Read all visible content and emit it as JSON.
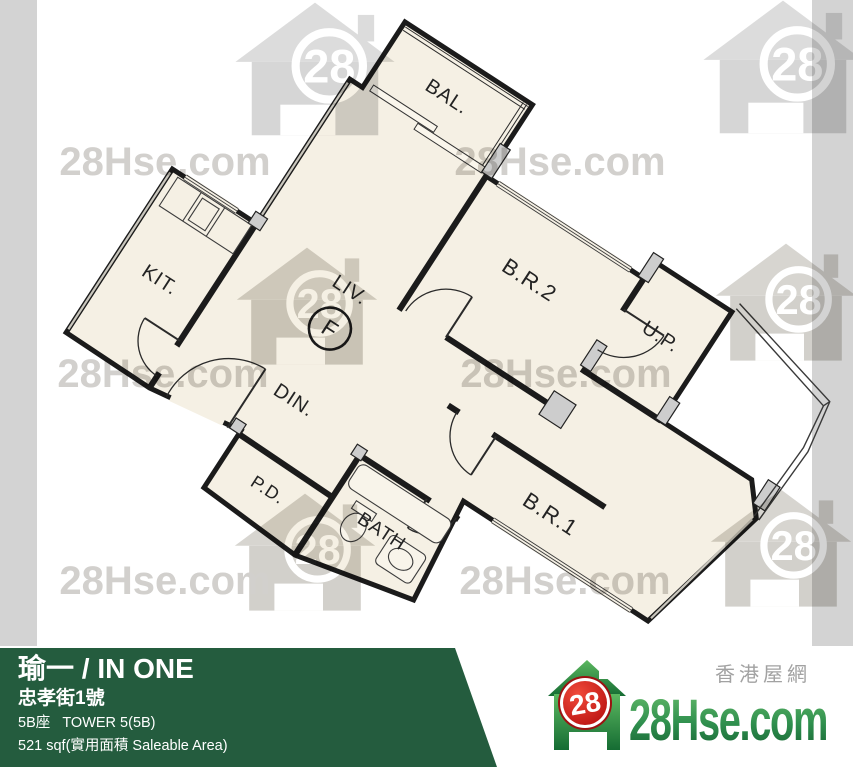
{
  "watermarks": {
    "site_text": "28Hse.com",
    "badge": "28"
  },
  "floor_plan": {
    "unit_label": "F",
    "rooms": {
      "balcony": "BAL.",
      "kitchen": "KIT.",
      "living": "LIV.",
      "dining": "DIN.",
      "bedroom2": "B.R.2",
      "utility_platform": "U.P.",
      "bedroom1": "B.R.1",
      "bath": "BATH",
      "pipe_duct": "P.D."
    }
  },
  "banner": {
    "title": "瑜一 / IN ONE",
    "address": "忠孝街1號",
    "tower": "5B座   TOWER 5(5B)",
    "area": "521 sqf(實用面積 Saleable Area)"
  },
  "logo": {
    "badge": "28",
    "wordmark": "28Hse.com",
    "site_cn": "香港屋網"
  },
  "colors": {
    "banner_green": "#245c3e",
    "floor_cream": "#f5f0e4",
    "wall_black": "#1b1b1b",
    "watermark_gray": "#d2d0cd",
    "edge_strip_gray": "#d3d3d3",
    "logo_red": "#cf1515",
    "logo_green": "#2f8f4e"
  }
}
